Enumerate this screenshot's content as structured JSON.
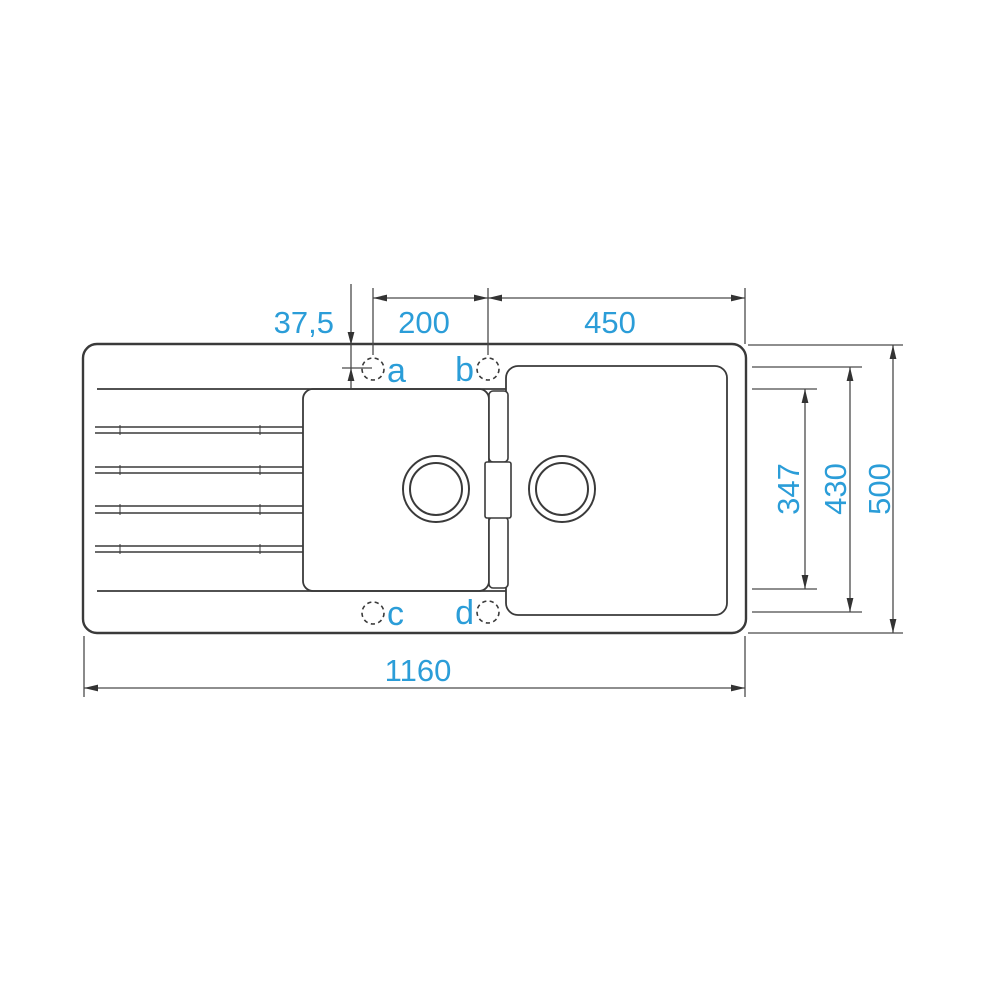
{
  "diagram": {
    "type": "technical-drawing",
    "subject": "kitchen sink with drainer, top view, dimensioned",
    "colors": {
      "accent_blue": "#2b9dd8",
      "outline_dark": "#3a3a3a",
      "dimension_line": "#4a4a4a",
      "background": "#ffffff"
    },
    "dimensions": {
      "edge_to_holes": "37,5",
      "hole_spacing": "200",
      "main_bowl_width": "450",
      "half_bowl_depth": "347",
      "hole_rows_span": "430",
      "overall_depth": "500",
      "overall_width": "1160"
    },
    "tap_holes": {
      "a": "a",
      "b": "b",
      "c": "c",
      "d": "d"
    }
  }
}
